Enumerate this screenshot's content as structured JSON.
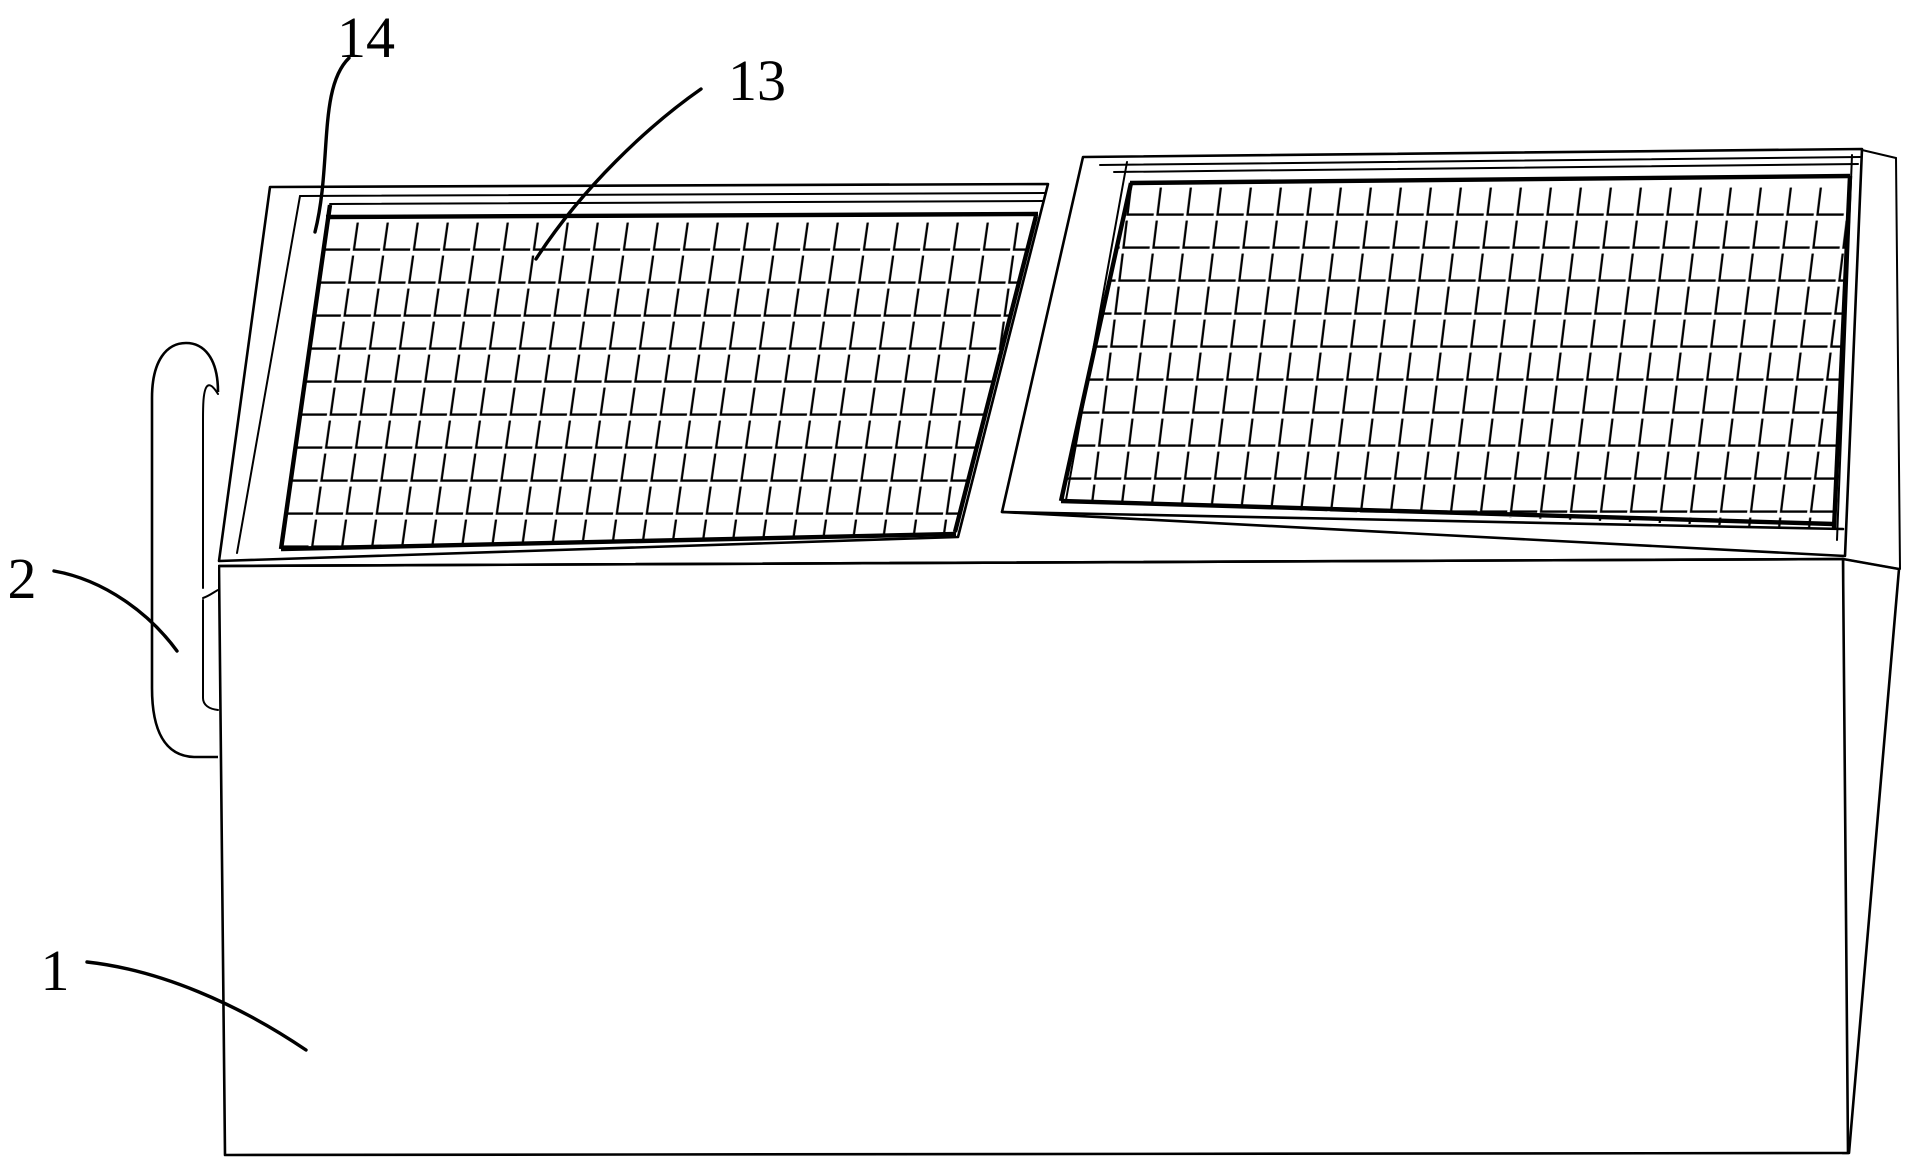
{
  "figure": {
    "kind": "patent-line-drawing",
    "description": "Box-shaped apparatus with side handle and two tilted mesh screen panels on top",
    "labels": {
      "box_body": "1",
      "handle": "2",
      "mesh_screen": "13",
      "screen_frame": "14"
    },
    "colors": {
      "line": "#000000",
      "background": "#ffffff"
    }
  }
}
